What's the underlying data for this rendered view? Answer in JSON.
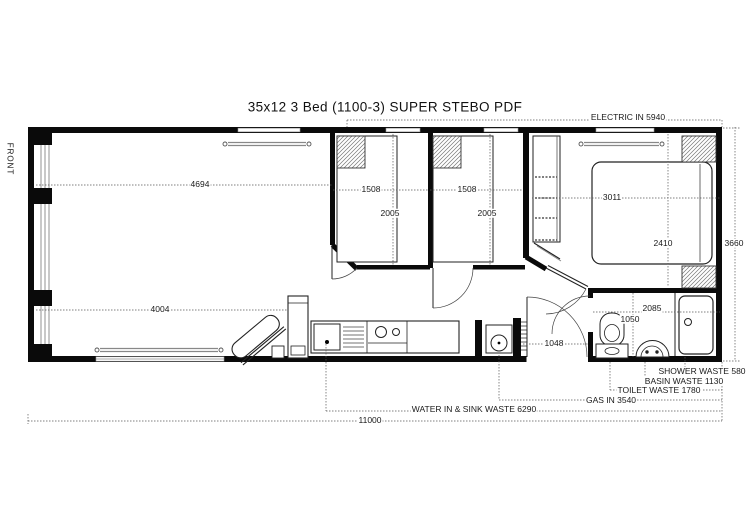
{
  "title": "35x12 3 Bed  (1100-3) SUPER  STEBO PDF",
  "plan": {
    "front_label": "FRONT",
    "dimensions": {
      "overall_length": "11000",
      "overall_width": "3660",
      "lounge_top": "4694",
      "lounge_bottom": "4004",
      "bedroom1_width": "1508",
      "bedroom1_depth": "2005",
      "bedroom2_width": "1508",
      "bedroom2_depth": "2005",
      "master_width": "3011",
      "master_depth": "2410",
      "bathroom_width": "2085",
      "toilet_zone": "1050",
      "hall_door": "1048"
    },
    "services": {
      "electric_in": "ELECTRIC IN 5940",
      "shower_waste": "SHOWER WASTE 580",
      "basin_waste": "BASIN WASTE 1130",
      "toilet_waste": "TOILET WASTE 1780",
      "gas_in": "GAS IN 3540",
      "water_in_sink_waste": "WATER IN & SINK WASTE 6290"
    }
  }
}
